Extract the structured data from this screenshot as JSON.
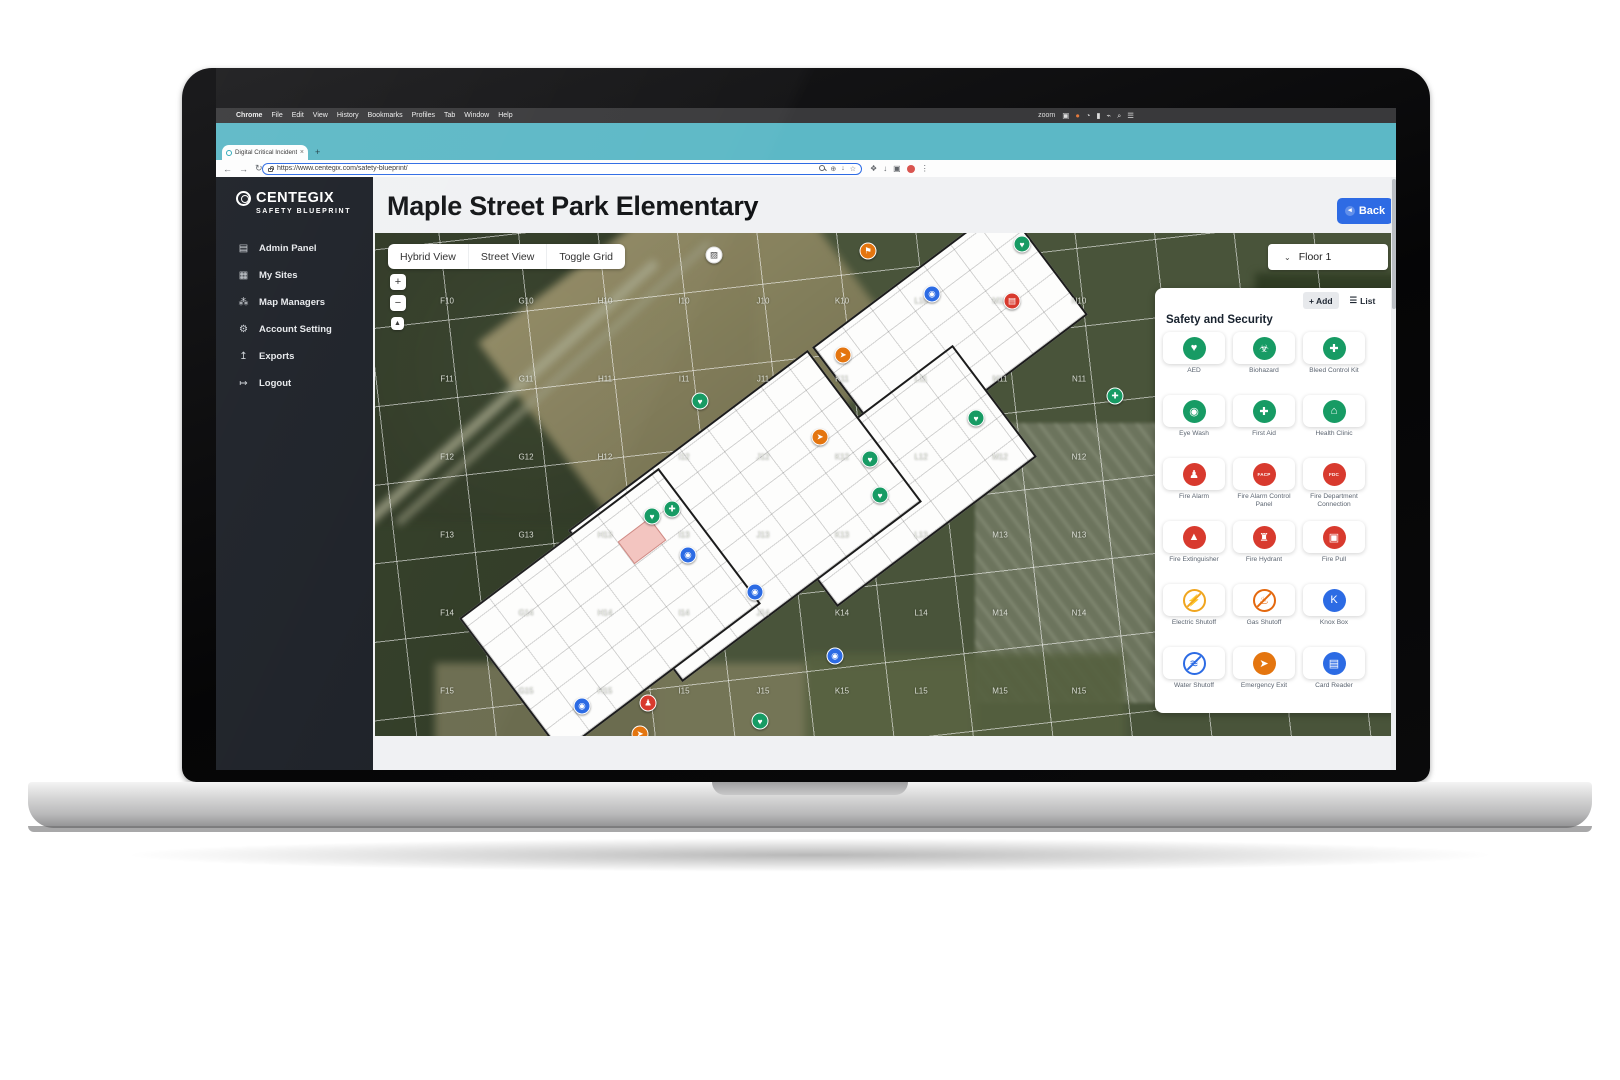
{
  "menu_bar": {
    "apple": "",
    "items": [
      "Chrome",
      "File",
      "Edit",
      "View",
      "History",
      "Bookmarks",
      "Profiles",
      "Tab",
      "Window",
      "Help"
    ],
    "right_label": "zoom",
    "right_icons": [
      "▣",
      "●",
      "◔",
      "▮",
      "⌁",
      "⌕",
      "☰"
    ]
  },
  "browser": {
    "tab_title": "Digital Critical Incident Mappi",
    "tab_close": "×",
    "new_tab": "+",
    "nav_icons": [
      "←",
      "→",
      "↻"
    ],
    "url": "https://www.centegix.com/safety-blueprint/",
    "omnibox_icons": [
      "⊕",
      "↓",
      "☆"
    ],
    "ext_icons": [
      "❖",
      "↓",
      "▣"
    ]
  },
  "sidebar": {
    "logo_title": "CENTEGIX",
    "logo_subtitle": "SAFETY BLUEPRINT",
    "items": [
      {
        "label": "Admin Panel",
        "icon_name": "admin-panel-icon",
        "glyph": "▤"
      },
      {
        "label": "My Sites",
        "icon_name": "my-sites-icon",
        "glyph": "▦"
      },
      {
        "label": "Map Managers",
        "icon_name": "map-managers-icon",
        "glyph": "⁂"
      },
      {
        "label": "Account Setting",
        "icon_name": "account-setting-icon",
        "glyph": "⚙"
      },
      {
        "label": "Exports",
        "icon_name": "exports-icon",
        "glyph": "↥"
      },
      {
        "label": "Logout",
        "icon_name": "logout-icon",
        "glyph": "↦"
      }
    ]
  },
  "header": {
    "title": "Maple Street Park Elementary",
    "back_label": "Back",
    "back_glyph": "◂"
  },
  "map": {
    "view_controls": [
      "Hybrid View",
      "Street View",
      "Toggle Grid"
    ],
    "zoom_in": "+",
    "zoom_out": "−",
    "recenter": "▲",
    "floor_selector": {
      "chevron": "⌄",
      "value": "Floor 1"
    },
    "grid": {
      "columns": [
        "F",
        "G",
        "H",
        "I",
        "J",
        "K",
        "L",
        "M",
        "N"
      ],
      "rows": [
        "10",
        "11",
        "12",
        "13",
        "14",
        "15"
      ],
      "origin_x": 72,
      "origin_y": 68,
      "pitch_x": 79,
      "pitch_y": 78
    },
    "markers": [
      {
        "type": "photo",
        "x": 339,
        "y": 22,
        "color": "#ffffff",
        "glyph": "▨",
        "glyph_color": "#444444"
      },
      {
        "type": "poi",
        "x": 493,
        "y": 18,
        "color": "#e4750f",
        "glyph": "⚑",
        "glyph_color": "#ffffff"
      },
      {
        "type": "camera",
        "x": 557,
        "y": 61,
        "color": "#2c6be4",
        "glyph": "◉",
        "glyph_color": "#ffffff"
      },
      {
        "type": "alarm-panel",
        "x": 637,
        "y": 68,
        "color": "#d83a2e",
        "glyph": "▤",
        "glyph_color": "#ffffff"
      },
      {
        "type": "aed",
        "x": 647,
        "y": 11,
        "color": "#179b64",
        "glyph": "♥",
        "glyph_color": "#ffffff"
      },
      {
        "type": "emergency-exit",
        "x": 468,
        "y": 122,
        "color": "#e4750f",
        "glyph": "➤",
        "glyph_color": "#ffffff"
      },
      {
        "type": "aed",
        "x": 325,
        "y": 168,
        "color": "#179b64",
        "glyph": "♥",
        "glyph_color": "#ffffff"
      },
      {
        "type": "emergency-exit",
        "x": 445,
        "y": 204,
        "color": "#e4750f",
        "glyph": "➤",
        "glyph_color": "#ffffff"
      },
      {
        "type": "aed",
        "x": 495,
        "y": 226,
        "color": "#179b64",
        "glyph": "♥",
        "glyph_color": "#ffffff"
      },
      {
        "type": "aed",
        "x": 601,
        "y": 185,
        "color": "#179b64",
        "glyph": "♥",
        "glyph_color": "#ffffff"
      },
      {
        "type": "aed",
        "x": 505,
        "y": 262,
        "color": "#179b64",
        "glyph": "♥",
        "glyph_color": "#ffffff"
      },
      {
        "type": "bleed-control",
        "x": 740,
        "y": 163,
        "color": "#179b64",
        "glyph": "✚",
        "glyph_color": "#ffffff"
      },
      {
        "type": "aed",
        "x": 277,
        "y": 283,
        "color": "#179b64",
        "glyph": "♥",
        "glyph_color": "#ffffff"
      },
      {
        "type": "bleed-control",
        "x": 297,
        "y": 276,
        "color": "#179b64",
        "glyph": "✚",
        "glyph_color": "#ffffff"
      },
      {
        "type": "camera",
        "x": 313,
        "y": 322,
        "color": "#2c6be4",
        "glyph": "◉",
        "glyph_color": "#ffffff"
      },
      {
        "type": "camera",
        "x": 380,
        "y": 359,
        "color": "#2c6be4",
        "glyph": "◉",
        "glyph_color": "#ffffff"
      },
      {
        "type": "camera",
        "x": 460,
        "y": 423,
        "color": "#2c6be4",
        "glyph": "◉",
        "glyph_color": "#ffffff"
      },
      {
        "type": "camera",
        "x": 207,
        "y": 473,
        "color": "#2c6be4",
        "glyph": "◉",
        "glyph_color": "#ffffff"
      },
      {
        "type": "fire-alarm",
        "x": 273,
        "y": 470,
        "color": "#d83a2e",
        "glyph": "♟",
        "glyph_color": "#ffffff"
      },
      {
        "type": "aed",
        "x": 385,
        "y": 488,
        "color": "#179b64",
        "glyph": "♥",
        "glyph_color": "#ffffff"
      },
      {
        "type": "emergency-exit",
        "x": 265,
        "y": 501,
        "color": "#e4750f",
        "glyph": "➤",
        "glyph_color": "#ffffff"
      }
    ]
  },
  "panel": {
    "add_label": "+ Add",
    "list_label": "List",
    "list_glyph": "☰",
    "section_title": "Safety and Security",
    "items": [
      {
        "label": "AED",
        "glyph": "♥",
        "color": "#179b64",
        "style": "solid",
        "slash": false
      },
      {
        "label": "Biohazard",
        "glyph": "☣",
        "color": "#179b64",
        "style": "solid",
        "slash": false
      },
      {
        "label": "Bleed Control Kit",
        "glyph": "✚",
        "color": "#179b64",
        "style": "solid",
        "slash": false
      },
      {
        "label": "Eye Wash",
        "glyph": "◉",
        "color": "#179b64",
        "style": "solid",
        "slash": false
      },
      {
        "label": "First Aid",
        "glyph": "✚",
        "color": "#179b64",
        "style": "solid",
        "slash": false
      },
      {
        "label": "Health Clinic",
        "glyph": "⌂",
        "color": "#179b64",
        "style": "solid",
        "slash": false
      },
      {
        "label": "Fire Alarm",
        "glyph": "♟",
        "color": "#d83a2e",
        "style": "solid",
        "slash": false
      },
      {
        "label": "Fire Alarm Control Panel",
        "glyph": "FACP",
        "color": "#d83a2e",
        "style": "solid",
        "slash": false
      },
      {
        "label": "Fire Department Connection",
        "glyph": "FDC",
        "color": "#d83a2e",
        "style": "solid",
        "slash": false
      },
      {
        "label": "Fire Extinguisher",
        "glyph": "▲",
        "color": "#d83a2e",
        "style": "solid",
        "slash": false
      },
      {
        "label": "Fire Hydrant",
        "glyph": "♜",
        "color": "#d83a2e",
        "style": "solid",
        "slash": false
      },
      {
        "label": "Fire Pull",
        "glyph": "▣",
        "color": "#d83a2e",
        "style": "solid",
        "slash": false
      },
      {
        "label": "Electric Shutoff",
        "glyph": "⚡",
        "color": "#f0a51e",
        "style": "outline",
        "slash": true
      },
      {
        "label": "Gas Shutoff",
        "glyph": "♨",
        "color": "#e4680d",
        "style": "outline",
        "slash": true
      },
      {
        "label": "Knox Box",
        "glyph": "K",
        "color": "#2c6be4",
        "style": "solid",
        "slash": false
      },
      {
        "label": "Water Shutoff",
        "glyph": "≋",
        "color": "#2c6be4",
        "style": "outline",
        "slash": true
      },
      {
        "label": "Emergency Exit",
        "glyph": "➤",
        "color": "#e4750f",
        "style": "solid",
        "slash": false
      },
      {
        "label": "Card Reader",
        "glyph": "▤",
        "color": "#2c6be4",
        "style": "solid",
        "slash": false
      }
    ]
  }
}
